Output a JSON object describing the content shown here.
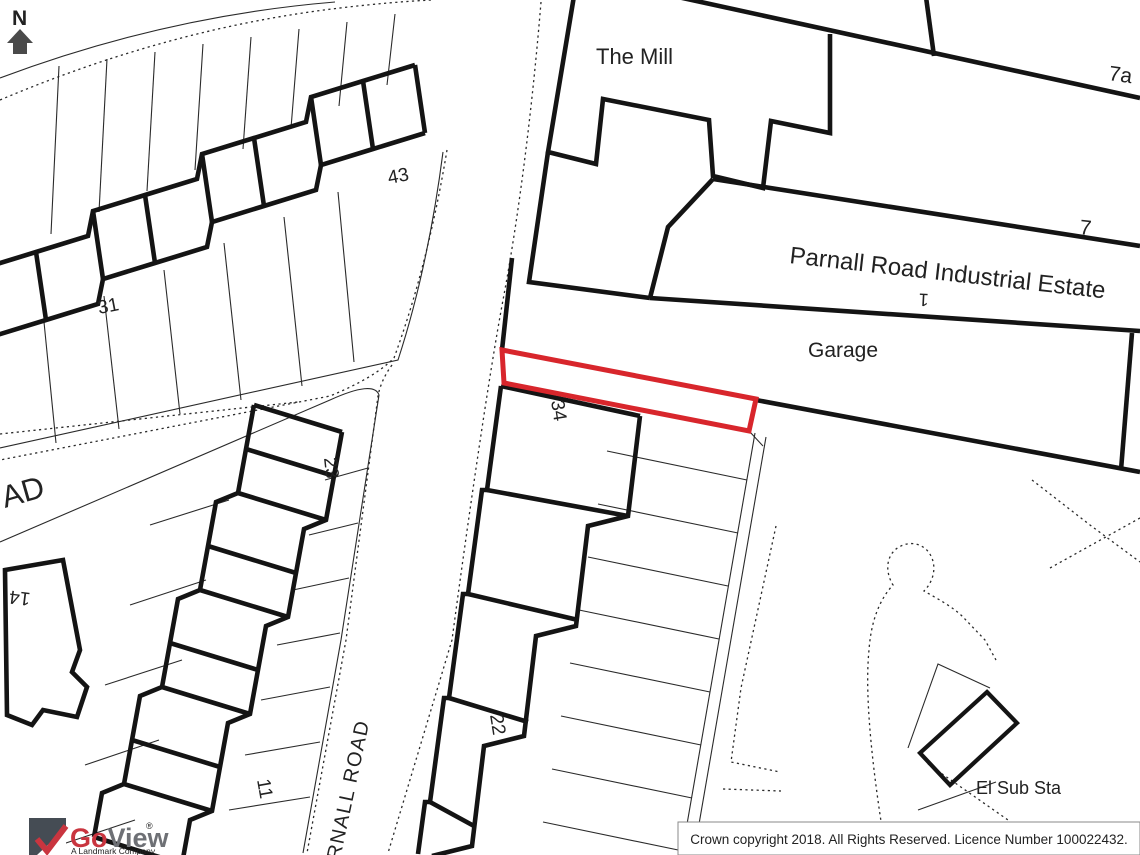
{
  "map": {
    "north_label": "N",
    "labels": {
      "mill": "The Mill",
      "unit7a": "7a",
      "unit7": "7",
      "industrial_estate": "Parnall Road Industrial Estate",
      "garage": "Garage",
      "unit1": "1",
      "no34": "34",
      "no22": "22",
      "no23": "23",
      "no11": "11",
      "no31": "31",
      "no43": "43",
      "no14": "14",
      "road_ad": "AD",
      "parnall_road": "PARNALL ROAD",
      "el_sub_sta": "El Sub Sta"
    },
    "colors": {
      "site_boundary": "#d8262c",
      "linework": "#1c1c1c"
    }
  },
  "logo": {
    "brand_go": "Go",
    "brand_view": "View",
    "registered": "®",
    "tagline": "A Landmark Company",
    "brand_red": "#c9353f",
    "brand_gray": "#6e7075"
  },
  "copyright": {
    "text": "Crown copyright 2018. All Rights Reserved. Licence Number 100022432."
  }
}
